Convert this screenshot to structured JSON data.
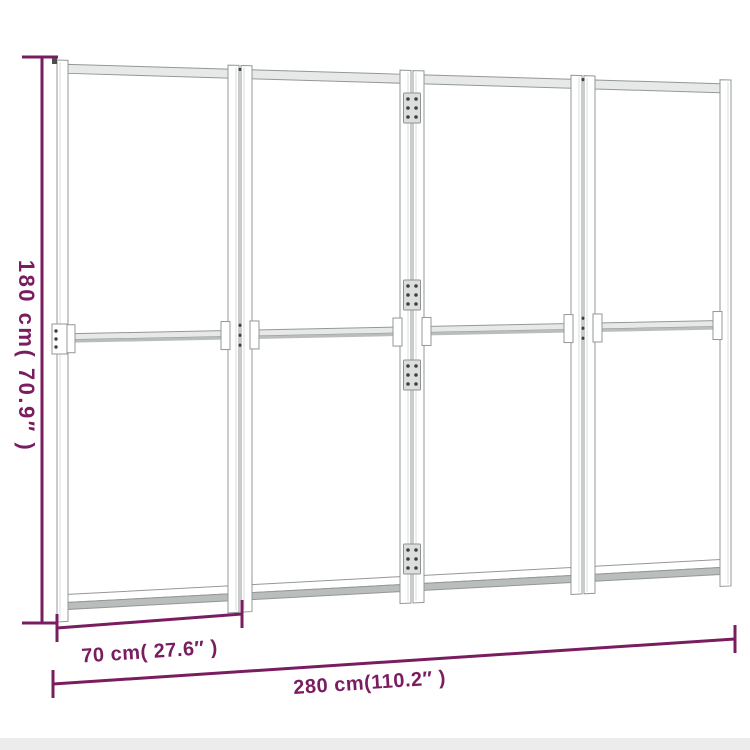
{
  "dimensions": {
    "height": {
      "label": "180 cm( 70.9″ )"
    },
    "panel_width": {
      "label": "70 cm( 27.6″ )"
    },
    "total_width": {
      "label": "280 cm(110.2″ )"
    }
  },
  "colors": {
    "dimension_accent": "#7a1d60",
    "frame_line": "#939897",
    "background": "#ffffff"
  }
}
